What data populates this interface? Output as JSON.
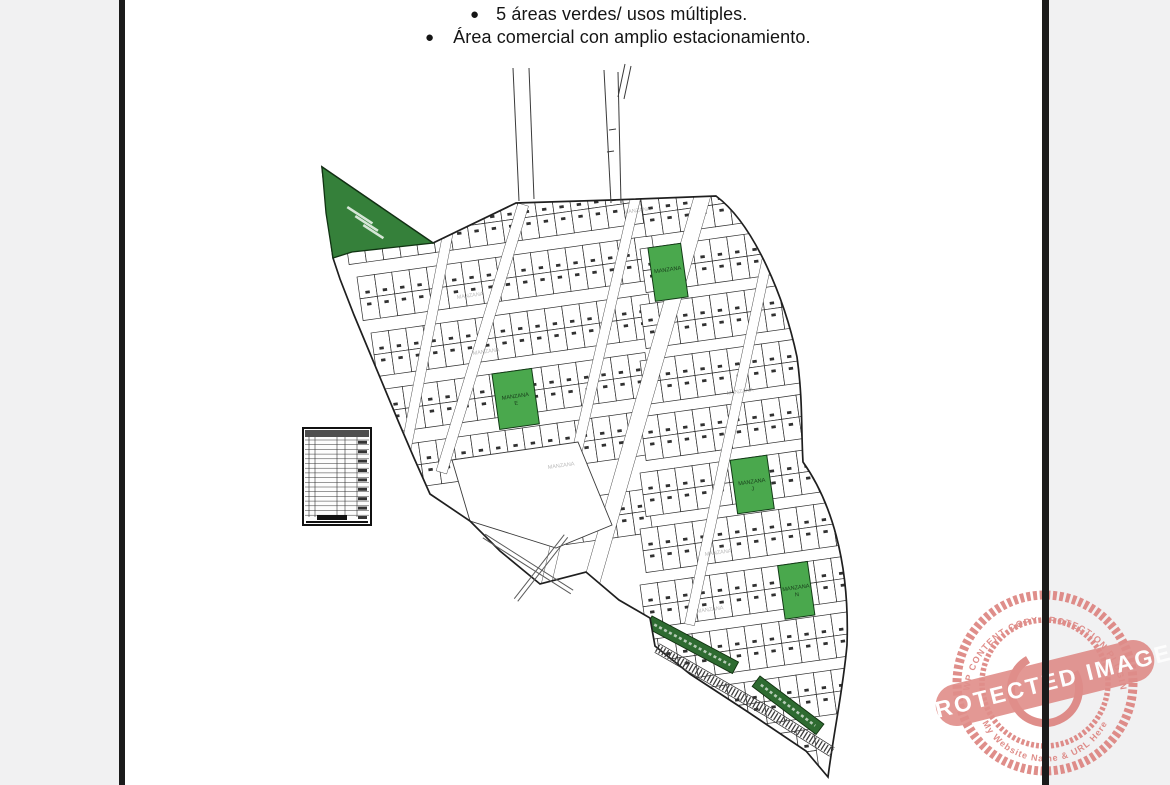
{
  "page": {
    "background": "#f1f1f2",
    "paper": "#ffffff",
    "edge_bar_color": "#1b1b1b"
  },
  "bullets": [
    {
      "text": "5 áreas verdes/ usos múltiples."
    },
    {
      "text": "Área comercial con amplio estacionamiento."
    }
  ],
  "map": {
    "line_color": "#2e2e2e",
    "green_dark": "#35803a",
    "green_block": "#4aa84d",
    "green_strip": "#2e6b31",
    "boundary": "M322,167 L433,243 L516,203 L612,200 L716,196 C755,225 785,300 797,357 C803,400 801,430 803,462 C830,500 850,560 847,645 C843,690 834,730 828,777 L806,751 L748,712 L690,674 L655,646 L650,618 L619,600 L586,572 L540,584 L500,551 L470,521 L430,494 L414,458 L399,423 L384,387 L369,351 L354,315 L340,279 L333,258 Z",
    "triangle_points": "322,167 433,243 352,252 333,258 326,213",
    "lot": {
      "w": 17.5,
      "h": 22,
      "angle": -8
    },
    "bands_west": [
      {
        "x": 343,
        "top": 221,
        "cols": 18
      },
      {
        "x": 357,
        "top": 277,
        "cols": 17
      },
      {
        "x": 371,
        "top": 333,
        "cols": 16
      },
      {
        "x": 385,
        "top": 389,
        "cols": 15
      },
      {
        "x": 401,
        "top": 445,
        "cols": 14
      },
      {
        "x": 560,
        "top": 501,
        "cols": 5
      }
    ],
    "bands_east": [
      {
        "x": 640,
        "top": 193,
        "cols": 14
      },
      {
        "x": 640,
        "top": 249,
        "cols": 14
      },
      {
        "x": 640,
        "top": 305,
        "cols": 14
      },
      {
        "x": 640,
        "top": 361,
        "cols": 14
      },
      {
        "x": 640,
        "top": 417,
        "cols": 14
      },
      {
        "x": 640,
        "top": 473,
        "cols": 14
      },
      {
        "x": 640,
        "top": 529,
        "cols": 14
      },
      {
        "x": 640,
        "top": 585,
        "cols": 14
      },
      {
        "x": 640,
        "top": 641,
        "cols": 14
      },
      {
        "x": 640,
        "top": 697,
        "cols": 14
      },
      {
        "x": 640,
        "top": 753,
        "cols": 10
      }
    ],
    "streets": [
      {
        "x": 445,
        "y": 222,
        "w": 10,
        "len": 250,
        "lean": 11
      },
      {
        "x": 518,
        "y": 203,
        "w": 11,
        "len": 280,
        "lean": 17
      },
      {
        "x": 632,
        "y": 191,
        "w": 10,
        "len": 460,
        "lean": 13
      },
      {
        "x": 697,
        "y": 186,
        "w": 16,
        "len": 525,
        "lean": 16
      },
      {
        "x": 774,
        "y": 203,
        "w": 10,
        "len": 430,
        "lean": 12
      }
    ],
    "open_area_points": "452,460 578,442 612,525 556,548 470,521",
    "crossed_roads": [
      [
        484,
        536,
        572,
        592
      ],
      [
        566,
        536,
        516,
        600
      ]
    ],
    "hatch_path": "M657,648 L770,713 L832,752",
    "green_blocks": [
      {
        "ax": 640,
        "top": 249,
        "x": 648,
        "w": 33,
        "h": 54,
        "label": "MANZANA",
        "letter": ""
      },
      {
        "ax": 385,
        "top": 389,
        "x": 493,
        "w": 40,
        "h": 56,
        "label": "MANZANA",
        "letter": "E"
      },
      {
        "ax": 640,
        "top": 473,
        "x": 731,
        "w": 37,
        "h": 54,
        "label": "MANZANA",
        "letter": "J"
      },
      {
        "ax": 640,
        "top": 585,
        "x": 779,
        "w": 30,
        "h": 54,
        "label": "MANZANA",
        "letter": "N"
      }
    ],
    "green_strips": [
      {
        "x": 652,
        "y": 616,
        "len": 98,
        "ang": 28
      },
      {
        "x": 760,
        "y": 676,
        "len": 80,
        "ang": 37
      }
    ],
    "faint_label_text": "MANZANA",
    "faint_labels": [
      [
        418,
        243
      ],
      [
        457,
        299
      ],
      [
        473,
        355
      ],
      [
        548,
        469
      ],
      [
        624,
        214
      ],
      [
        727,
        395
      ],
      [
        705,
        556
      ],
      [
        697,
        613
      ]
    ],
    "top_roads": [
      [
        513,
        68,
        519,
        201
      ],
      [
        529,
        68,
        534,
        199
      ],
      [
        604,
        70,
        611,
        203
      ],
      [
        618,
        72,
        621,
        203
      ],
      [
        625,
        64,
        618,
        97
      ],
      [
        631,
        66,
        624,
        99
      ],
      [
        609,
        130,
        616,
        129
      ],
      [
        607,
        152,
        614,
        151
      ]
    ]
  },
  "legend": {
    "x": 303,
    "y": 428,
    "w": 68,
    "h": 97,
    "rows": 17,
    "col_offsets": [
      6,
      12,
      34,
      42,
      54
    ]
  },
  "stamp": {
    "cx": 1045,
    "cy": 683,
    "r_outer": 88,
    "r_inner": 63,
    "color": "#dc827e",
    "banner": "PROTECTED IMAGE",
    "arc_top": "WP CONTENT COPY PROTECTION PLUGIN",
    "arc_bottom": "My Website Name & URL Here"
  }
}
